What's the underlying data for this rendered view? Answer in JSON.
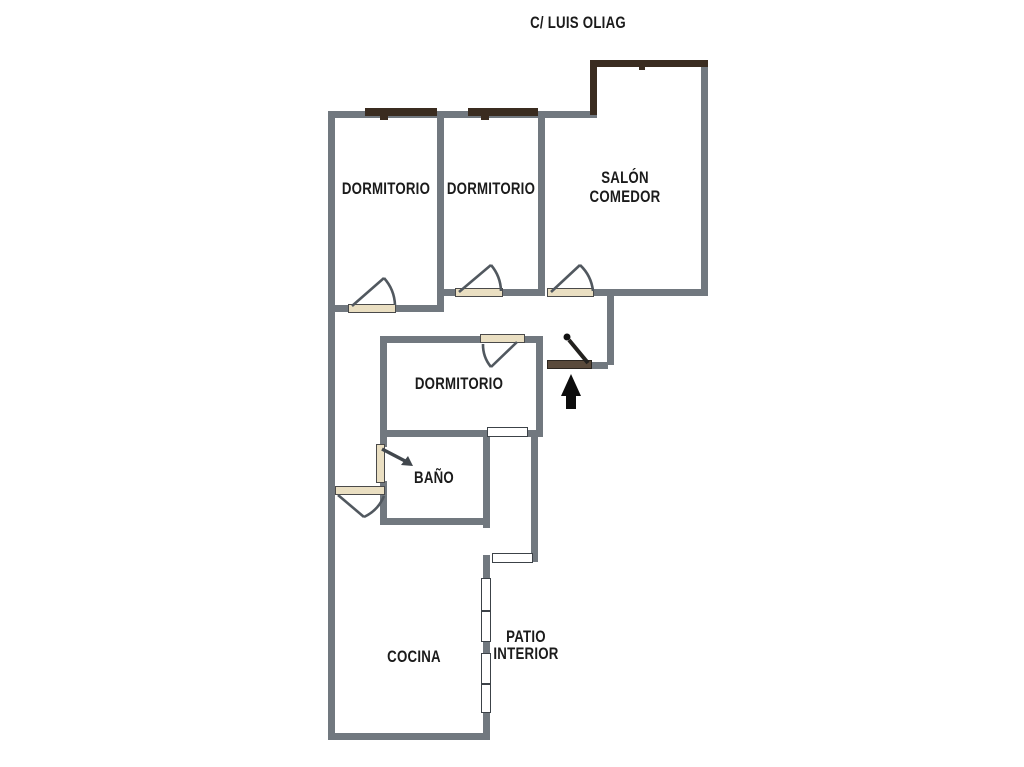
{
  "title": "C/ LUIS OLIAG",
  "rooms": {
    "dormitorio_top_left": "DORMITORIO",
    "dormitorio_top_middle": "DORMITORIO",
    "salon_line1": "SALÓN",
    "salon_line2": "COMEDOR",
    "dormitorio_middle": "DORMITORIO",
    "bano": "BAÑO",
    "cocina": "COCINA",
    "patio_line1": "PATIO",
    "patio_line2": "INTERIOR"
  },
  "colors": {
    "wall": "#71787f",
    "street_window": "#3a2c20",
    "entrance_door": "#5a4a3b",
    "door_sill": "#eadfc2",
    "interior_window": "#ffffff",
    "text": "#1b1b1b"
  }
}
